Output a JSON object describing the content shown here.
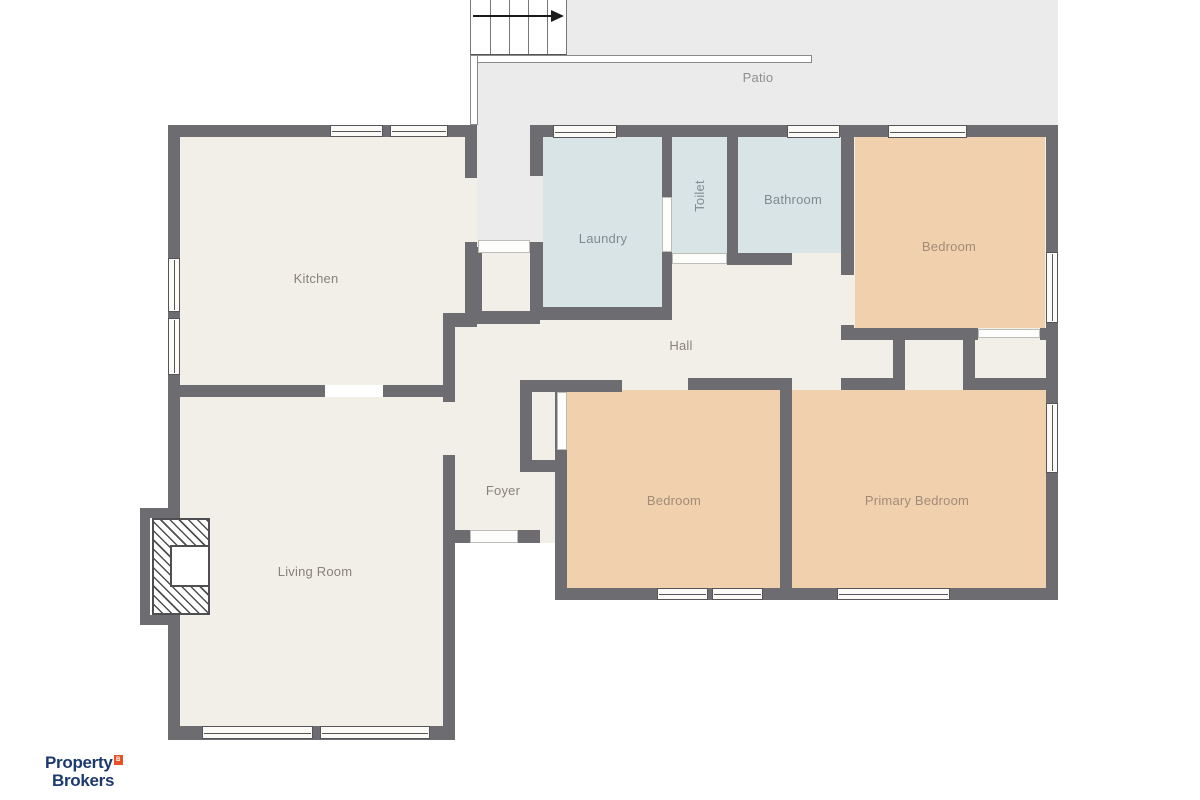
{
  "title": "Floor plan",
  "logo": {
    "line1": "Property",
    "line2": "Brokers",
    "badge": "B"
  },
  "colors": {
    "wall": "#6d6d71",
    "floor": "#f2efe8",
    "wet_room": "#d9e4e7",
    "bedroom": "#f1d0ae",
    "outdoor": "#ebebeb",
    "logo_navy": "#1c3a6e",
    "logo_orange": "#e55226"
  },
  "plan": {
    "fills": [
      {
        "name": "area-top-right-floor",
        "rect": [
          530,
          125,
          528,
          265
        ],
        "color": "#f2efe8"
      },
      {
        "name": "area-bottom-right-floor",
        "rect": [
          555,
          378,
          503,
          222
        ],
        "color": "#f2efe8"
      },
      {
        "name": "room-kitchen-floor",
        "rect": [
          180,
          137,
          285,
          248
        ],
        "color": "#f2efe8"
      },
      {
        "name": "kitchen-door-gap",
        "rect": [
          465,
          178,
          12,
          64
        ],
        "color": "#f2efe8"
      },
      {
        "name": "room-living-floor",
        "rect": [
          180,
          397,
          263,
          330
        ],
        "color": "#f2efe8"
      },
      {
        "name": "area-hall-foyer-floor",
        "rect": [
          443,
          240,
          245,
          303
        ],
        "color": "#f2efe8"
      },
      {
        "name": "room-laundry-floor",
        "rect": [
          543,
          137,
          119,
          170
        ],
        "color": "#d9e4e7"
      },
      {
        "name": "room-toilet-floor",
        "rect": [
          672,
          137,
          55,
          116
        ],
        "color": "#d9e4e7"
      },
      {
        "name": "room-bathroom-floor",
        "rect": [
          738,
          137,
          103,
          116
        ],
        "color": "#d9e4e7"
      },
      {
        "name": "room-bedroom-top-floor",
        "rect": [
          855,
          137,
          190,
          191
        ],
        "color": "#f1d0ae"
      },
      {
        "name": "room-bedroom-bottom-floor",
        "rect": [
          567,
          390,
          213,
          198
        ],
        "color": "#f1d0ae"
      },
      {
        "name": "room-primary-bedroom-floor",
        "rect": [
          792,
          390,
          254,
          198
        ],
        "color": "#f1d0ae"
      },
      {
        "name": "patio-area",
        "rect": [
          567,
          0,
          491,
          125
        ],
        "color": "#ebebeb"
      },
      {
        "name": "patio-area-left",
        "rect": [
          478,
          62,
          89,
          63
        ],
        "color": "#ebebeb"
      },
      {
        "name": "rear-walkway",
        "rect": [
          477,
          62,
          53,
          178
        ],
        "color": "#ebebeb"
      },
      {
        "name": "rear-walkway-gap",
        "rect": [
          530,
          176,
          13,
          66
        ],
        "color": "#ebebeb"
      }
    ],
    "walls": [
      [
        168,
        125,
        309,
        12
      ],
      [
        530,
        125,
        528,
        12
      ],
      [
        168,
        125,
        12,
        615
      ],
      [
        168,
        726,
        287,
        14
      ],
      [
        180,
        385,
        145,
        12
      ],
      [
        383,
        385,
        72,
        12
      ],
      [
        465,
        125,
        12,
        53
      ],
      [
        465,
        242,
        12,
        71
      ],
      [
        443,
        313,
        34,
        14
      ],
      [
        443,
        327,
        12,
        75
      ],
      [
        443,
        455,
        12,
        285
      ],
      [
        530,
        125,
        13,
        51
      ],
      [
        530,
        242,
        13,
        78
      ],
      [
        470,
        247,
        12,
        77
      ],
      [
        470,
        311,
        70,
        13
      ],
      [
        662,
        137,
        10,
        60
      ],
      [
        662,
        252,
        10,
        68
      ],
      [
        530,
        307,
        142,
        13
      ],
      [
        727,
        137,
        11,
        126
      ],
      [
        727,
        253,
        65,
        12
      ],
      [
        841,
        137,
        13,
        138
      ],
      [
        841,
        325,
        13,
        15
      ],
      [
        843,
        328,
        135,
        12
      ],
      [
        1040,
        328,
        18,
        12
      ],
      [
        893,
        328,
        12,
        62
      ],
      [
        963,
        328,
        12,
        62
      ],
      [
        841,
        378,
        59,
        12
      ],
      [
        963,
        378,
        95,
        12
      ],
      [
        688,
        378,
        104,
        12
      ],
      [
        567,
        380,
        55,
        12
      ],
      [
        520,
        380,
        47,
        12
      ],
      [
        520,
        380,
        12,
        92
      ],
      [
        520,
        460,
        47,
        12
      ],
      [
        555,
        380,
        12,
        220
      ],
      [
        780,
        380,
        12,
        220
      ],
      [
        555,
        588,
        503,
        12
      ],
      [
        1046,
        125,
        12,
        475
      ],
      [
        443,
        530,
        27,
        13
      ],
      [
        518,
        530,
        22,
        13
      ],
      [
        140,
        508,
        40,
        10
      ],
      [
        140,
        508,
        10,
        117
      ],
      [
        140,
        615,
        40,
        10
      ]
    ],
    "doors": [
      [
        662,
        197,
        10,
        55
      ],
      [
        672,
        253,
        55,
        11
      ],
      [
        478,
        240,
        52,
        13
      ],
      [
        470,
        530,
        48,
        13
      ],
      [
        978,
        329,
        62,
        9
      ],
      [
        557,
        392,
        10,
        58
      ]
    ],
    "deck": [
      [
        470,
        55,
        342,
        8
      ],
      [
        470,
        55,
        8,
        70
      ]
    ],
    "windows": {
      "h": [
        [
          330,
          125,
          53,
          12
        ],
        [
          390,
          125,
          58,
          12
        ],
        [
          553,
          125,
          64,
          13
        ],
        [
          787,
          125,
          53,
          13
        ],
        [
          888,
          125,
          79,
          13
        ],
        [
          657,
          588,
          51,
          12
        ],
        [
          712,
          588,
          51,
          12
        ],
        [
          837,
          588,
          113,
          12
        ],
        [
          202,
          726,
          111,
          13
        ],
        [
          320,
          726,
          110,
          13
        ]
      ],
      "v": [
        [
          168,
          258,
          12,
          54
        ],
        [
          168,
          318,
          12,
          57
        ],
        [
          1046,
          252,
          12,
          71
        ],
        [
          1046,
          403,
          12,
          70
        ]
      ]
    },
    "stairs": {
      "x": 470,
      "y": 0,
      "w": 97,
      "h": 55,
      "treads": [
        19,
        38,
        57,
        76
      ],
      "arrow_top": 15
    },
    "fireplace": {
      "outer": [
        152,
        518,
        58,
        97
      ],
      "inner": [
        170,
        545,
        40,
        42
      ]
    },
    "labels": [
      {
        "id": "patio",
        "text": "Patio",
        "x": 758,
        "y": 78,
        "color": "#8f8f8f"
      },
      {
        "id": "kitchen",
        "text": "Kitchen",
        "x": 316,
        "y": 279,
        "color": "#87837c"
      },
      {
        "id": "laundry",
        "text": "Laundry",
        "x": 603,
        "y": 239,
        "color": "#7e8c90"
      },
      {
        "id": "toilet",
        "text": "Toilet",
        "x": 700,
        "y": 196,
        "color": "#7e8c90",
        "rot": -90
      },
      {
        "id": "bathroom",
        "text": "Bathroom",
        "x": 793,
        "y": 200,
        "color": "#7e8c90"
      },
      {
        "id": "bedroom-top",
        "text": "Bedroom",
        "x": 949,
        "y": 247,
        "color": "#a18c77"
      },
      {
        "id": "hall",
        "text": "Hall",
        "x": 681,
        "y": 346,
        "color": "#87837c"
      },
      {
        "id": "foyer",
        "text": "Foyer",
        "x": 503,
        "y": 491,
        "color": "#87837c"
      },
      {
        "id": "bedroom-bottom",
        "text": "Bedroom",
        "x": 674,
        "y": 501,
        "color": "#a18c77"
      },
      {
        "id": "primary-bedroom",
        "text": "Primary Bedroom",
        "x": 917,
        "y": 501,
        "color": "#a18c77"
      },
      {
        "id": "living-room",
        "text": "Living Room",
        "x": 315,
        "y": 572,
        "color": "#87837c"
      }
    ]
  }
}
